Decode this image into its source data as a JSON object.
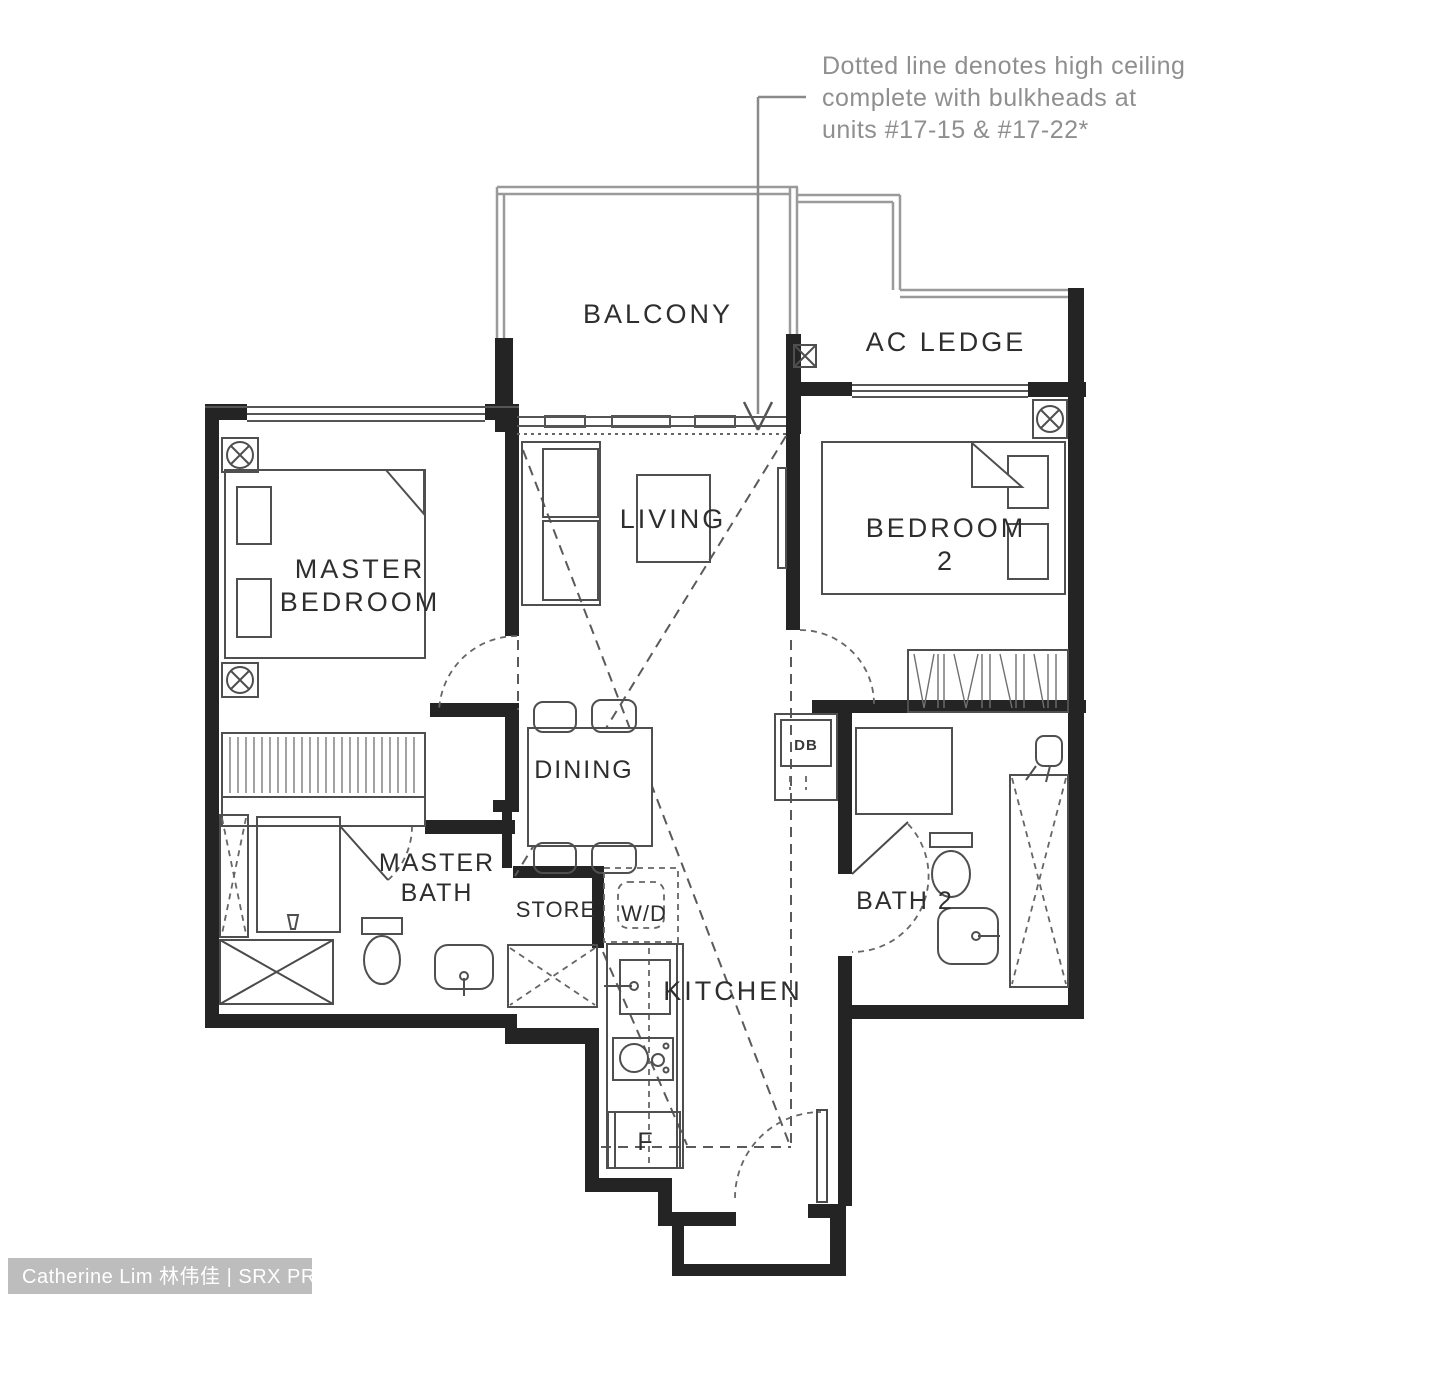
{
  "annotation": {
    "line1": "Dotted line denotes high ceiling",
    "line2": "complete with bulkheads at",
    "line3": "units #17-15 & #17-22*"
  },
  "labels": {
    "balcony": "BALCONY",
    "ac_ledge": "AC LEDGE",
    "master_bedroom_line1": "MASTER",
    "master_bedroom_line2": "BEDROOM",
    "living": "LIVING",
    "bedroom2_line1": "BEDROOM",
    "bedroom2_line2": "2",
    "dining": "DINING",
    "master_bath_line1": "MASTER",
    "master_bath_line2": "BATH",
    "bath2": "BATH 2",
    "store": "STORE",
    "washer_dryer": "W/D",
    "kitchen": "KITCHEN",
    "fridge": "F",
    "db_box": "DB"
  },
  "watermark": {
    "agent": "Catherine Lim 林伟佳 | SRX PROPERTY"
  },
  "colors": {
    "wall": "#242424",
    "thin_line": "#4a4a4a",
    "outer_light_line": "#9a9a9a",
    "dashed_line": "#5a5a5a",
    "label_text": "#2e2e2e",
    "annotation_text": "#8f8f8f",
    "watermark_bg": "#bdbdbd",
    "watermark_text": "#ffffff",
    "background": "#ffffff"
  }
}
